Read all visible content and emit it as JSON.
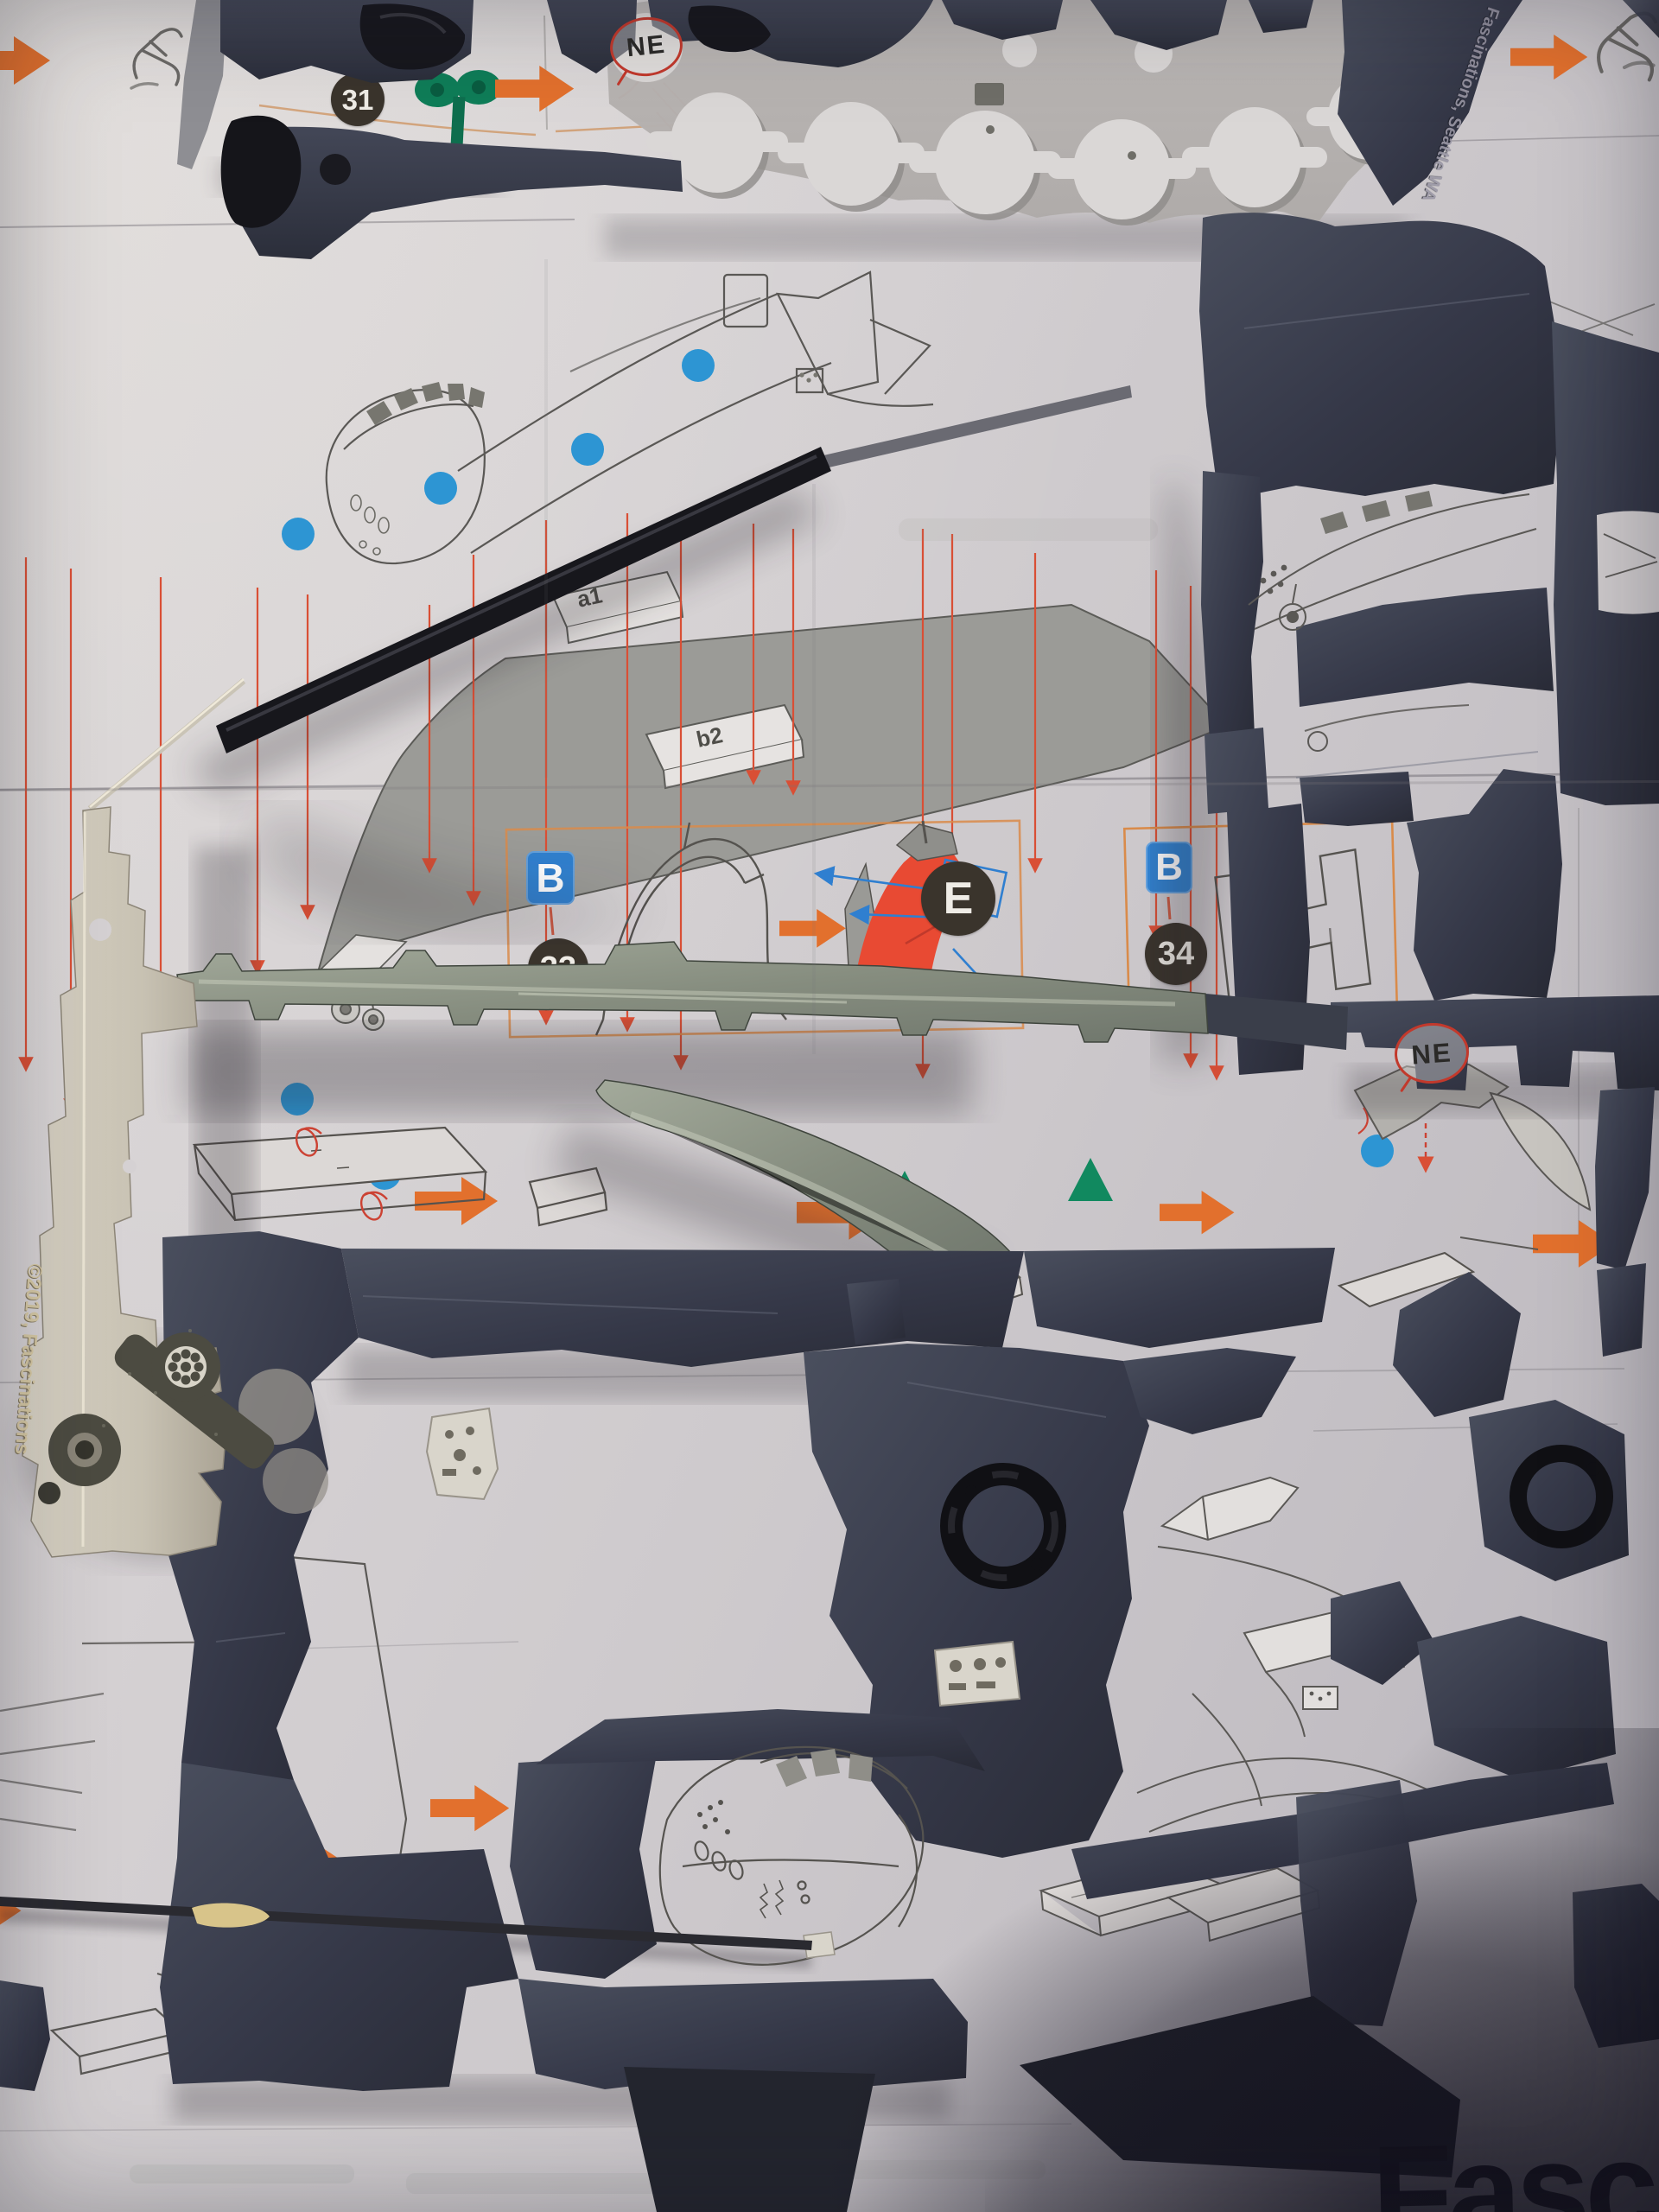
{
  "colors": {
    "paper": "#d5d1d3",
    "sprue_dark_navy": "#383c49",
    "fret_silver": "#cfc9bd",
    "rail_galvanized": "#8b9284",
    "accent_orange": "#e2702d",
    "accent_red": "#da4a30",
    "accent_blue_dot": "#2d95d3",
    "badge_blue": "#3181cf",
    "badge_dark_circle": "#3a342c",
    "accent_green": "#11895f",
    "part_red_highlight": "#e84a33",
    "rod_black": "#1b1a20",
    "logo_black": "#15141b"
  },
  "labels": {
    "step31_number": "31",
    "step33_plate_letter": "B",
    "step33_number": "33",
    "step33_callout_letter": "E",
    "step34_plate_letter": "B",
    "step34_number": "34",
    "ne_top": "NE",
    "ne_middle": "NE",
    "part_a1": "a1",
    "part_b2": "b2"
  },
  "engravings": {
    "left_fret_copyright": "©2019, Fascinations",
    "right_sprue_brand": "Fascinations, Seattle WA"
  },
  "logo": {
    "partial_text": "Fasci"
  },
  "icons": [
    "orange-arrow-icon",
    "blue-dot-marker",
    "green-triangle-marker",
    "green-twist-tool-icon",
    "cutter-tool-icon",
    "ne-callout-bubble",
    "blue-direction-arrow-icon",
    "red-guide-line"
  ]
}
